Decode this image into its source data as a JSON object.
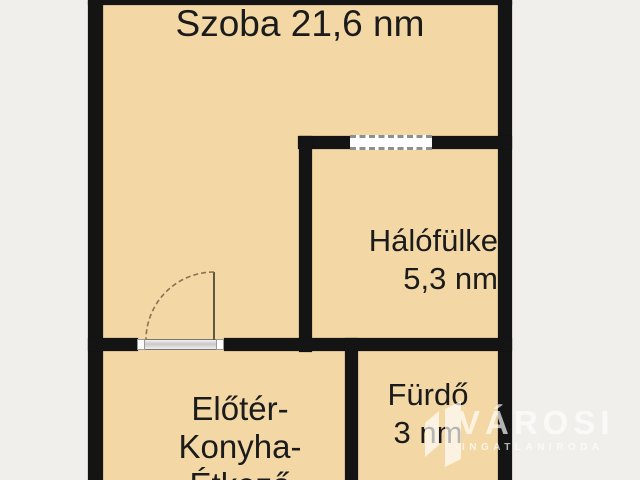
{
  "colors": {
    "canvas_background": "#f0efeb",
    "room_fill": "#f3d8a6",
    "wall": "#141414",
    "label_text": "#1b1b1b",
    "watermark_text": "#ffffff",
    "door_arc": "#8a7350",
    "window_dash": "#8f8f8f"
  },
  "rooms": {
    "szoba": {
      "label": "Szoba 21,6 nm"
    },
    "halofulke": {
      "name": "Hálófülke",
      "area": "5,3 nm"
    },
    "eloter": {
      "line1": "Előtér-",
      "line2": "Konyha-",
      "line3": "Étkező"
    },
    "furdo": {
      "name": "Fürdő",
      "area": "3 nm"
    }
  },
  "symbols": {
    "door": "door-swing-icon",
    "window": "window-icon"
  },
  "watermark": {
    "brand": "VÁROSI",
    "tagline": "INGATLANIRODA"
  }
}
